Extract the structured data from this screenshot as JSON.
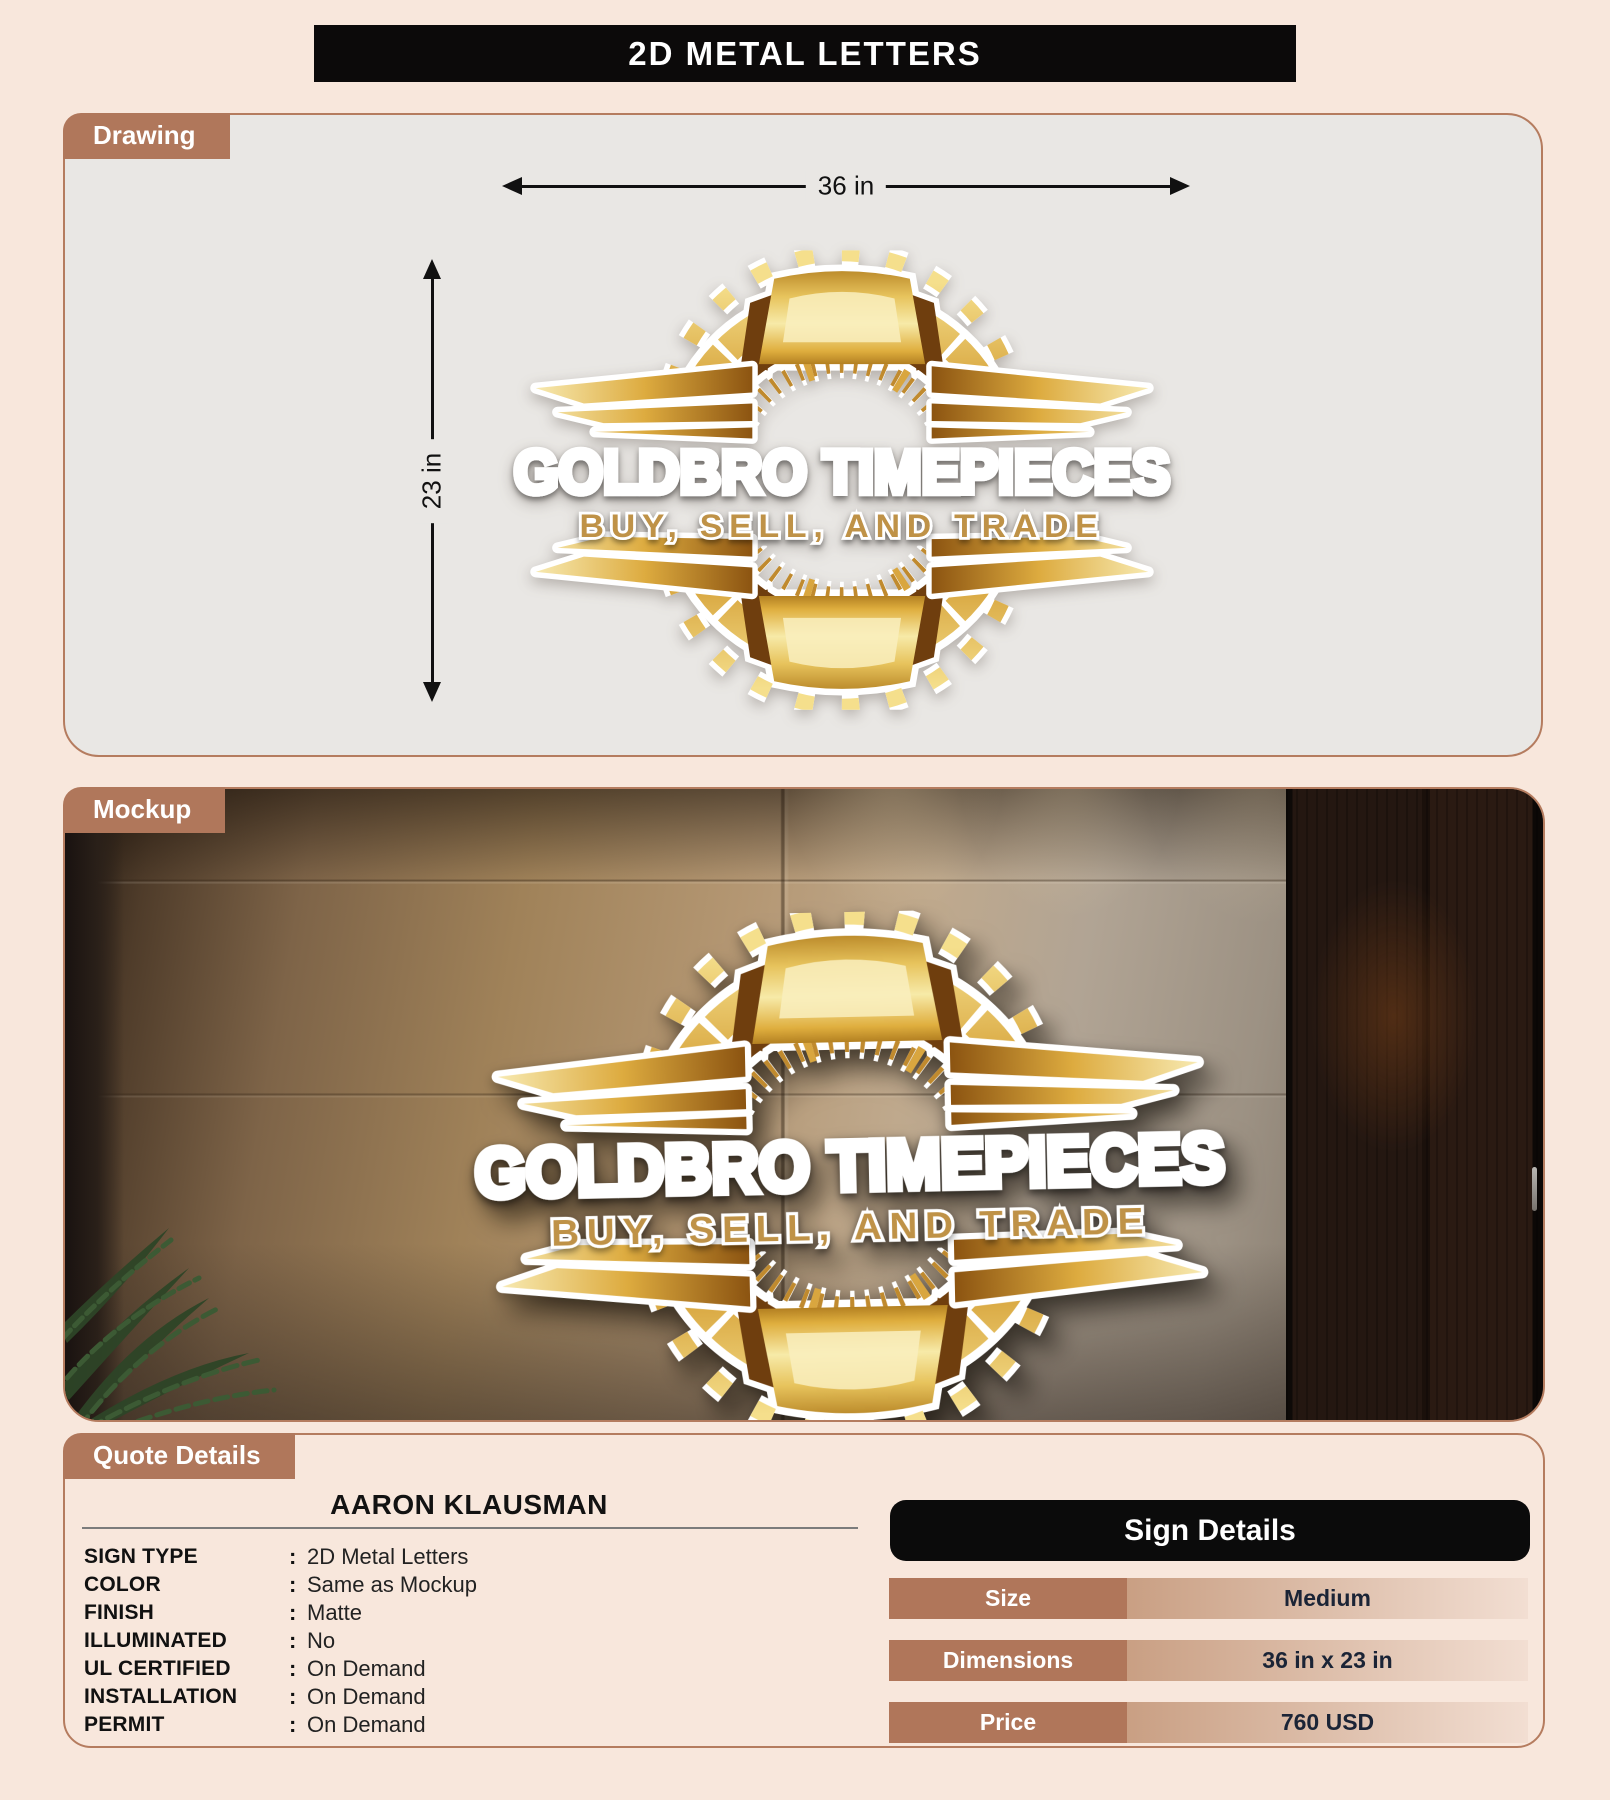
{
  "page": {
    "title": "2D METAL LETTERS"
  },
  "sections": {
    "drawing_label": "Drawing",
    "mockup_label": "Mockup",
    "quote_label": "Quote Details"
  },
  "drawing": {
    "width_label": "36 in",
    "height_label": "23 in"
  },
  "logo": {
    "title": "GOLDBRO TIMEPIECES",
    "subtitle": "BUY, SELL, AND TRADE"
  },
  "quote": {
    "customer": "AARON KLAUSMAN",
    "colon": ":",
    "rows": [
      {
        "label": "SIGN TYPE",
        "value": "2D Metal Letters"
      },
      {
        "label": "COLOR",
        "value": "Same as Mockup"
      },
      {
        "label": "FINISH",
        "value": "Matte"
      },
      {
        "label": "ILLUMINATED",
        "value": "No"
      },
      {
        "label": "UL CERTIFIED",
        "value": "On Demand"
      },
      {
        "label": "INSTALLATION",
        "value": "On Demand"
      },
      {
        "label": "PERMIT",
        "value": "On Demand"
      }
    ]
  },
  "sign_details": {
    "title": "Sign Details",
    "rows": [
      {
        "label": "Size",
        "value": "Medium"
      },
      {
        "label": "Dimensions",
        "value": "36 in x 23 in"
      },
      {
        "label": "Price",
        "value": "760 USD"
      }
    ]
  },
  "colors": {
    "page_bg": "#f8e7dc",
    "accent_tag": "#b0775b",
    "panel_border": "#b57c5f",
    "drawing_bg": "#e9e7e4",
    "banner_bg": "#0c0a0a",
    "gold": "#d7a43c",
    "subtitle_gold": "#bf9246",
    "value_text": "#1b2436"
  }
}
